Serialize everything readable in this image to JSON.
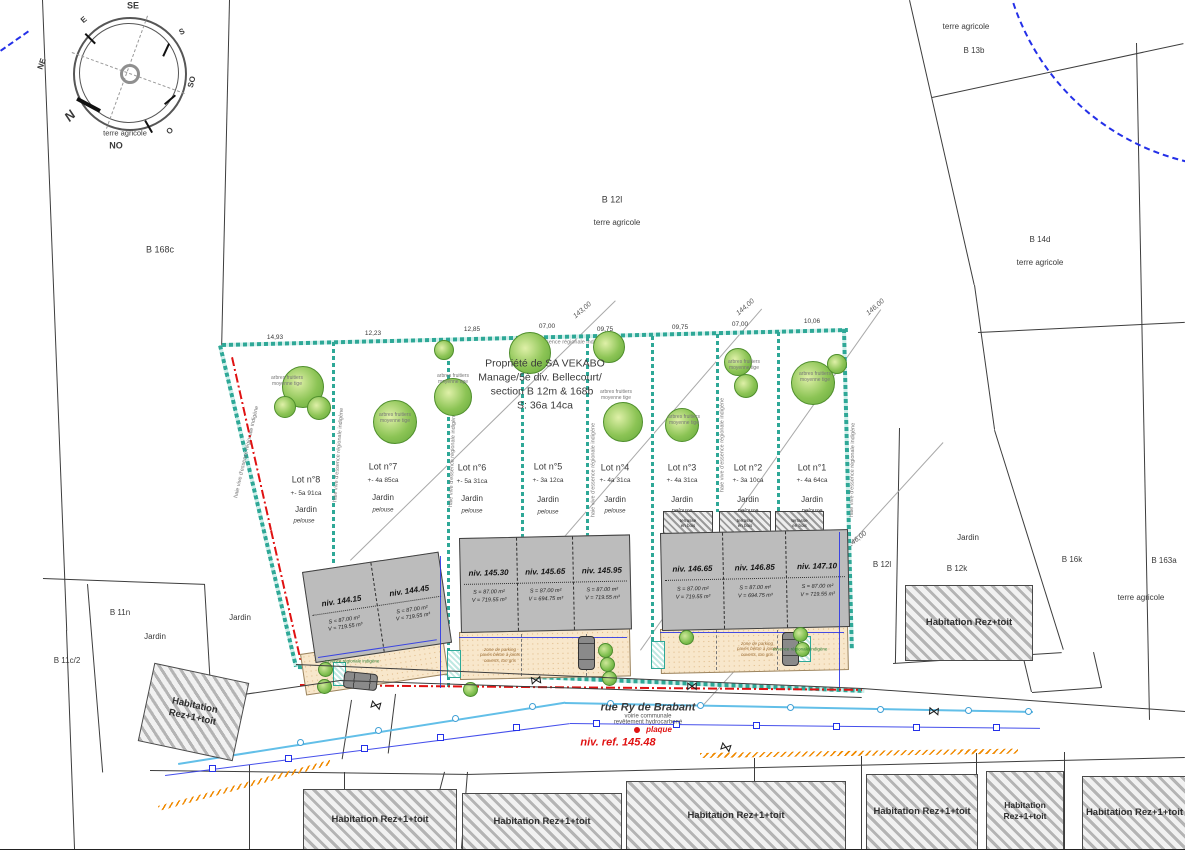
{
  "compass": {
    "n": "N",
    "ne": "NE",
    "e": "E",
    "se": "SE",
    "s": "S",
    "so": "SO",
    "o": "O",
    "no": "NO",
    "note": "terre agricole"
  },
  "title_block": {
    "line1": "Propriété de SA VEKABO",
    "line2": "Manage/5è div. Bellecourt/",
    "line3": "section B 12m & 168b",
    "line4": "S: 36a 14ca"
  },
  "parcels": [
    {
      "label": "B 168c"
    },
    {
      "label": "B 12l"
    },
    {
      "label": "terre agricole"
    },
    {
      "label": "terre agricole"
    },
    {
      "label": "B 13b"
    },
    {
      "label": "B 14d"
    },
    {
      "label": "terre agricole"
    },
    {
      "label": "B 12l"
    },
    {
      "label": "Jardin"
    },
    {
      "label": "B 12k"
    },
    {
      "label": "B 16k"
    },
    {
      "label": "B 163a"
    },
    {
      "label": "terre agricole"
    },
    {
      "label": "B 11n"
    },
    {
      "label": "Jardin"
    },
    {
      "label": "B 11c/2"
    },
    {
      "label": "Jardin"
    },
    {
      "label": "terre agricole"
    }
  ],
  "lots": [
    {
      "name": "Lot n°8",
      "area": "+- 5a 91ca",
      "use": "Jardin",
      "ground": "pelouse"
    },
    {
      "name": "Lot n°7",
      "area": "+- 4a 85ca",
      "use": "Jardin",
      "ground": "pelouse"
    },
    {
      "name": "Lot n°6",
      "area": "+- 5a 31ca",
      "use": "Jardin",
      "ground": "pelouse"
    },
    {
      "name": "Lot n°5",
      "area": "+- 3a 12ca",
      "use": "Jardin",
      "ground": "pelouse"
    },
    {
      "name": "Lot n°4",
      "area": "+- 4a 31ca",
      "use": "Jardin",
      "ground": "pelouse"
    },
    {
      "name": "Lot n°3",
      "area": "+- 4a 31ca",
      "use": "Jardin",
      "ground": "pelouse"
    },
    {
      "name": "Lot n°2",
      "area": "+- 3a 10ca",
      "use": "Jardin",
      "ground": "pelouse"
    },
    {
      "name": "Lot n°1",
      "area": "+- 4a 64ca",
      "use": "Jardin",
      "ground": "pelouse"
    }
  ],
  "buildings": [
    {
      "units": [
        {
          "level": "niv. 144.15",
          "surface": "S = 87.00 m²",
          "volume": "V = 719.55 m³"
        },
        {
          "level": "niv. 144.45",
          "surface": "S = 87.00 m²",
          "volume": "V = 719.55 m³"
        }
      ]
    },
    {
      "units": [
        {
          "level": "niv. 145.30",
          "surface": "S = 87.00 m²",
          "volume": "V = 719.55 m³"
        },
        {
          "level": "niv. 145.65",
          "surface": "S = 87.00 m²",
          "volume": "V = 694.75 m³"
        },
        {
          "level": "niv. 145.95",
          "surface": "S = 87.00 m²",
          "volume": "V = 719.55 m³"
        }
      ]
    },
    {
      "units": [
        {
          "level": "niv. 146.65",
          "surface": "S = 87.00 m²",
          "volume": "V = 719.55 m³"
        },
        {
          "level": "niv. 146.85",
          "surface": "S = 87.00 m²",
          "volume": "V = 694.75 m³"
        },
        {
          "level": "niv. 147.10",
          "surface": "S = 87.00 m²",
          "volume": "V = 719.55 m³"
        }
      ]
    }
  ],
  "site": {
    "hedge_label": "haie vive d'essence régionale indigène",
    "fruit_trees_label": "arbres fruitiers\nmoyenne tige",
    "new_plant_label": "essence régionale indigène",
    "parking_label": "zone de parking\npavés béton à joints\nouverts, ton gris",
    "terrace_label": "terrasse\nen bois",
    "dimensions": [
      "14,93",
      "12,23",
      "12,85",
      "07,00",
      "09,75",
      "09,75",
      "07,00",
      "10,06"
    ],
    "contours": [
      "143,00",
      "144,00",
      "146,00",
      "146,00"
    ]
  },
  "street": {
    "name": "rue Ry de Brabant",
    "type": "voirie communale",
    "surface": "revêtement hydrocarboné",
    "plaque": "plaque",
    "ref_level": "niv. ref. 145.48"
  },
  "habitation": {
    "r1": "Habitation Rez+1+toit",
    "r0": "Habitation Rez+toit"
  },
  "icons": {
    "survey_mark": "⋈"
  }
}
